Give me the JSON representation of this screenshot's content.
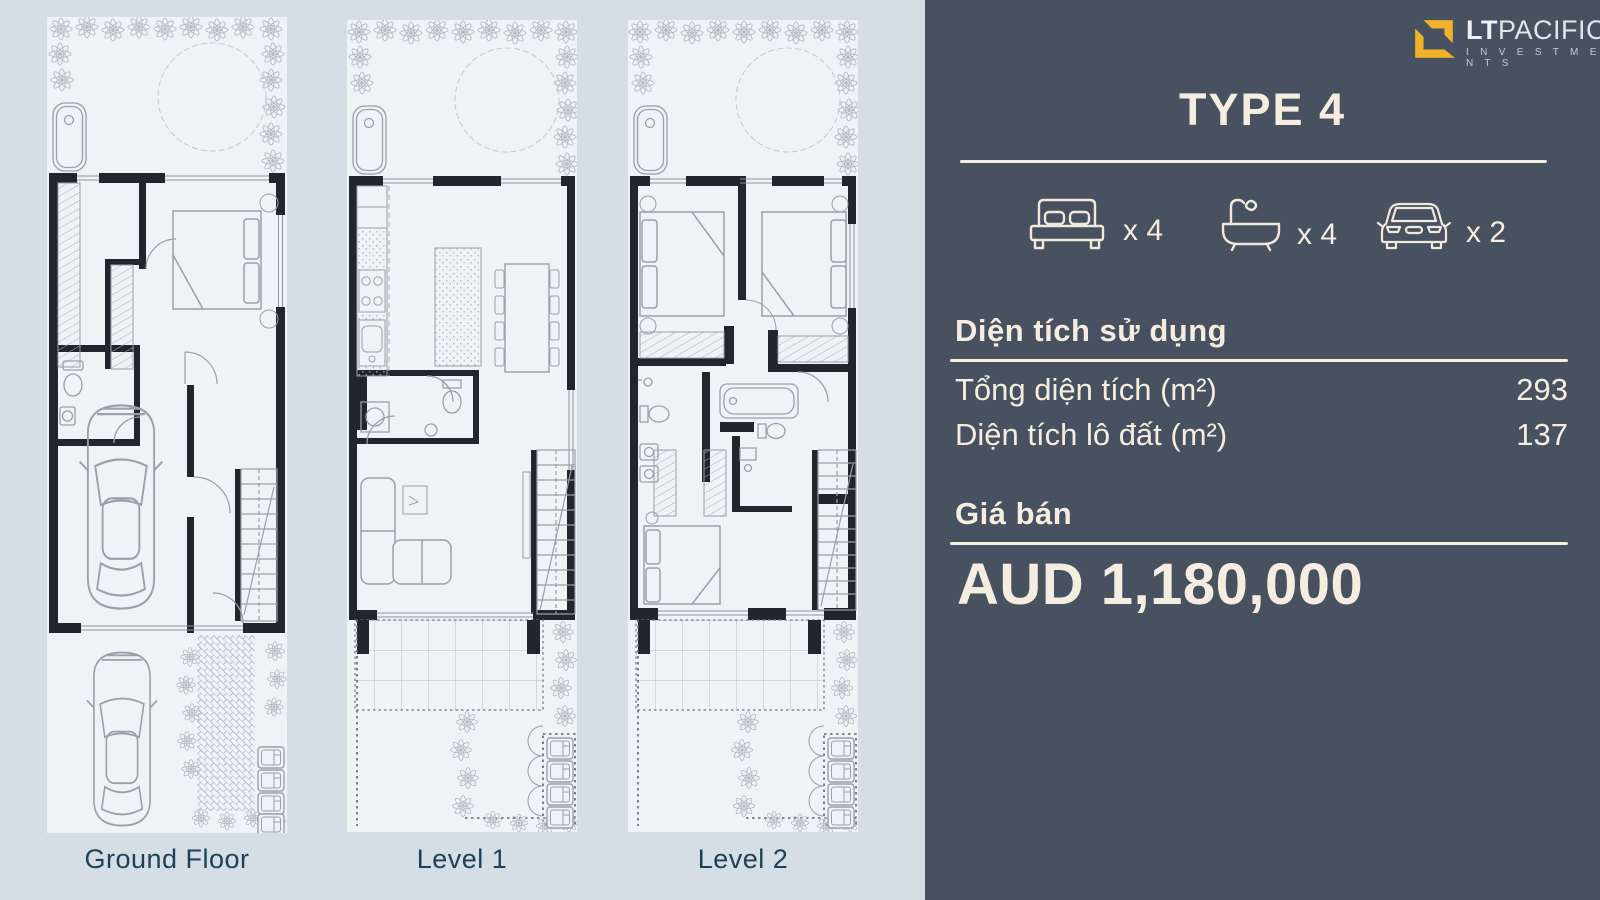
{
  "colors": {
    "page_bg": "#d4dee4",
    "panel_bg": "#48515f",
    "cream_text": "#f6ede1",
    "logo_gold": "#efb32b",
    "plan_bg": "#eef3f6",
    "plan_label": "#1d4156",
    "wall_black": "#20262c"
  },
  "logo": {
    "lt": "LT",
    "pacific": "PACIFIC",
    "investments": "I N V E S T M E N T S"
  },
  "panel": {
    "title": "TYPE 4",
    "features": [
      {
        "icon": "bed-icon",
        "count": "x 4"
      },
      {
        "icon": "bath-icon",
        "count": "x 4"
      },
      {
        "icon": "car-icon",
        "count": "x 2"
      }
    ],
    "area_section": {
      "heading": "Diện tích sử dụng",
      "rows": [
        {
          "label": "Tổng diện tích (m²)",
          "value": "293"
        },
        {
          "label": "Diện tích lô đất (m²)",
          "value": "137"
        }
      ]
    },
    "price_section": {
      "heading": "Giá bán",
      "price": "AUD 1,180,000"
    }
  },
  "plans": [
    {
      "label": "Ground Floor"
    },
    {
      "label": "Level 1"
    },
    {
      "label": "Level 2"
    }
  ]
}
